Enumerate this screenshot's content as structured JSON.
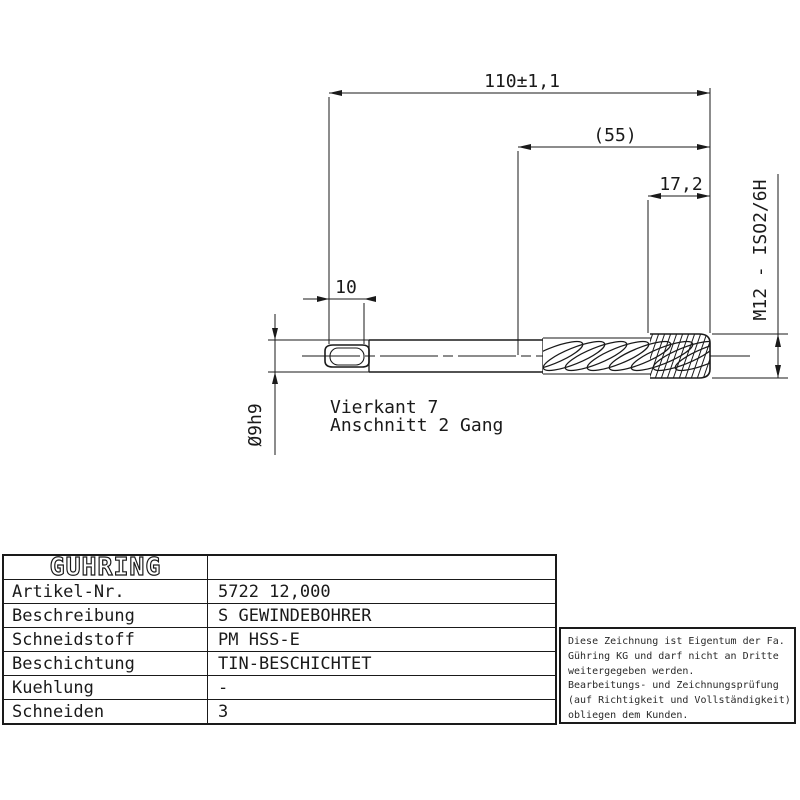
{
  "colors": {
    "ink": "#1a1a1a",
    "paper": "#ffffff"
  },
  "drawing": {
    "dims": {
      "overall_length": "110±1,1",
      "flute_length": "(55)",
      "chamfer_length": "17,2",
      "square_length": "10",
      "shank_diameter": "Ø9h9",
      "thread_spec": "M12 - ISO2/6H"
    },
    "notes": {
      "line1": "Vierkant 7",
      "line2": "Anschnitt 2 Gang"
    }
  },
  "titleblock": {
    "logo": "GÜHRING",
    "rows": [
      {
        "label": "Artikel-Nr.",
        "value": "5722 12,000"
      },
      {
        "label": "Beschreibung",
        "value": "S GEWINDEBOHRER"
      },
      {
        "label": "Schneidstoff",
        "value": "PM HSS-E"
      },
      {
        "label": "Beschichtung",
        "value": "TIN-BESCHICHTET"
      },
      {
        "label": "Kuehlung",
        "value": "-"
      },
      {
        "label": "Schneiden",
        "value": "3"
      }
    ]
  },
  "notice": {
    "lines": [
      "Diese Zeichnung ist Eigentum der Fa.",
      "Gühring KG und darf nicht an Dritte",
      "weitergegeben werden.",
      "Bearbeitungs- und Zeichnungsprüfung",
      "(auf Richtigkeit und Vollständigkeit)",
      "obliegen dem Kunden."
    ]
  }
}
